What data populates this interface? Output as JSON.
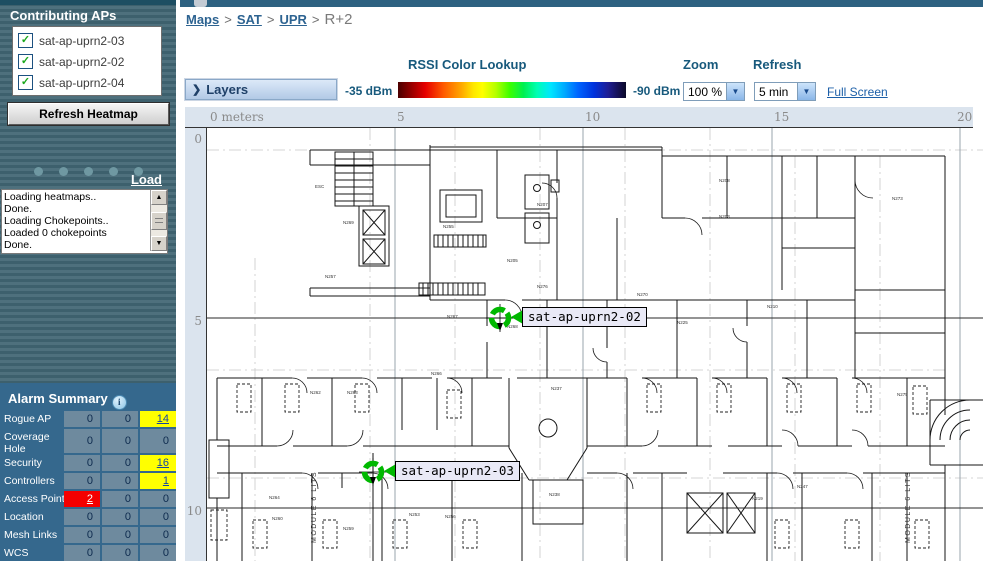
{
  "sidebar": {
    "contributing_aps_title": "Contributing APs",
    "aps": [
      {
        "label": "sat-ap-uprn2-03",
        "checked": true
      },
      {
        "label": "sat-ap-uprn2-02",
        "checked": true
      },
      {
        "label": "sat-ap-uprn2-04",
        "checked": true
      }
    ],
    "refresh_button": "Refresh Heatmap",
    "load_link": "Load",
    "status_lines": [
      "Loading heatmaps..",
      "Done.",
      "Loading Chokepoints..",
      "Loaded 0 chokepoints",
      "Done."
    ],
    "alarm": {
      "title": "Alarm Summary",
      "rows": [
        {
          "label": "Rogue AP",
          "cells": [
            {
              "v": "0"
            },
            {
              "v": "0"
            },
            {
              "v": "14",
              "bg": "yellow",
              "link": true
            }
          ]
        },
        {
          "label": "Coverage Hole",
          "cells": [
            {
              "v": "0"
            },
            {
              "v": "0"
            },
            {
              "v": "0"
            }
          ]
        },
        {
          "label": "Security",
          "cells": [
            {
              "v": "0"
            },
            {
              "v": "0"
            },
            {
              "v": "16",
              "bg": "yellow",
              "link": true
            }
          ]
        },
        {
          "label": "Controllers",
          "cells": [
            {
              "v": "0"
            },
            {
              "v": "0"
            },
            {
              "v": "1",
              "bg": "yellow",
              "link": true
            }
          ]
        },
        {
          "label": "Access Points",
          "cells": [
            {
              "v": "2",
              "bg": "red",
              "link": true
            },
            {
              "v": "0"
            },
            {
              "v": "0"
            }
          ]
        },
        {
          "label": "Location",
          "cells": [
            {
              "v": "0"
            },
            {
              "v": "0"
            },
            {
              "v": "0"
            }
          ]
        },
        {
          "label": "Mesh Links",
          "cells": [
            {
              "v": "0"
            },
            {
              "v": "0"
            },
            {
              "v": "0"
            }
          ]
        },
        {
          "label": "WCS",
          "cells": [
            {
              "v": "0"
            },
            {
              "v": "0"
            },
            {
              "v": "0"
            }
          ]
        }
      ]
    }
  },
  "breadcrumb": {
    "links": [
      "Maps",
      "SAT",
      "UPR"
    ],
    "separator": ">",
    "current": "R+2"
  },
  "toolbar": {
    "layers_label": "Layers",
    "layers_chevron": "❯",
    "rssi_title": "RSSI Color Lookup",
    "rssi_min": "-35 dBm",
    "rssi_max": "-90 dBm",
    "zoom_label": "Zoom",
    "zoom_value": "100 %",
    "refresh_label": "Refresh",
    "refresh_value": "5 min",
    "fullscreen_link": "Full Screen"
  },
  "map": {
    "ruler_x": [
      "0 meters",
      "5",
      "10",
      "15",
      "20"
    ],
    "ruler_y": [
      "0",
      "5",
      "10"
    ],
    "aps": [
      {
        "name": "sat-ap-uprn2-02",
        "x": 293,
        "y": 190
      },
      {
        "name": "sat-ap-uprn2-03",
        "x": 166,
        "y": 344
      }
    ],
    "module_text": "MODULE 6 LITS",
    "floor_labels": [
      {
        "t": "ESC",
        "x": 108,
        "y": 60
      },
      {
        "t": "N269",
        "x": 136,
        "y": 96
      },
      {
        "t": "N255",
        "x": 236,
        "y": 100
      },
      {
        "t": "N257",
        "x": 118,
        "y": 150
      },
      {
        "t": "N205",
        "x": 300,
        "y": 134
      },
      {
        "t": "N207",
        "x": 330,
        "y": 78
      },
      {
        "t": "N208",
        "x": 512,
        "y": 54
      },
      {
        "t": "N203",
        "x": 512,
        "y": 90
      },
      {
        "t": "N273",
        "x": 685,
        "y": 72
      },
      {
        "t": "N270",
        "x": 430,
        "y": 168
      },
      {
        "t": "N276",
        "x": 330,
        "y": 160
      },
      {
        "t": "N210",
        "x": 560,
        "y": 180
      },
      {
        "t": "N225",
        "x": 470,
        "y": 196
      },
      {
        "t": "N267",
        "x": 240,
        "y": 190
      },
      {
        "t": "N268",
        "x": 300,
        "y": 200
      },
      {
        "t": "N266",
        "x": 224,
        "y": 247
      },
      {
        "t": "N262",
        "x": 103,
        "y": 266
      },
      {
        "t": "N263",
        "x": 140,
        "y": 266
      },
      {
        "t": "N264",
        "x": 62,
        "y": 371
      },
      {
        "t": "N260",
        "x": 65,
        "y": 392
      },
      {
        "t": "N259",
        "x": 136,
        "y": 402
      },
      {
        "t": "N253",
        "x": 202,
        "y": 388
      },
      {
        "t": "N256",
        "x": 238,
        "y": 390
      },
      {
        "t": "N237",
        "x": 344,
        "y": 262
      },
      {
        "t": "N238",
        "x": 342,
        "y": 368
      },
      {
        "t": "N219",
        "x": 545,
        "y": 372
      },
      {
        "t": "N247",
        "x": 590,
        "y": 360
      },
      {
        "t": "N275",
        "x": 690,
        "y": 268
      },
      {
        "t": "MODULE 6 LITS",
        "x": 109,
        "y": 415,
        "rot": -90,
        "s": 7,
        "ls": 1
      },
      {
        "t": "MODULE 6 LITS",
        "x": 703,
        "y": 415,
        "rot": -90,
        "s": 7,
        "ls": 1
      }
    ]
  },
  "colors": {
    "alarm_yellow": "#ffff00",
    "alarm_red": "#f40000",
    "marker_green": "#00b800",
    "panel_blue": "#35688d",
    "rssi_start": "#4a0000",
    "rssi_end": "#0a0a28"
  }
}
